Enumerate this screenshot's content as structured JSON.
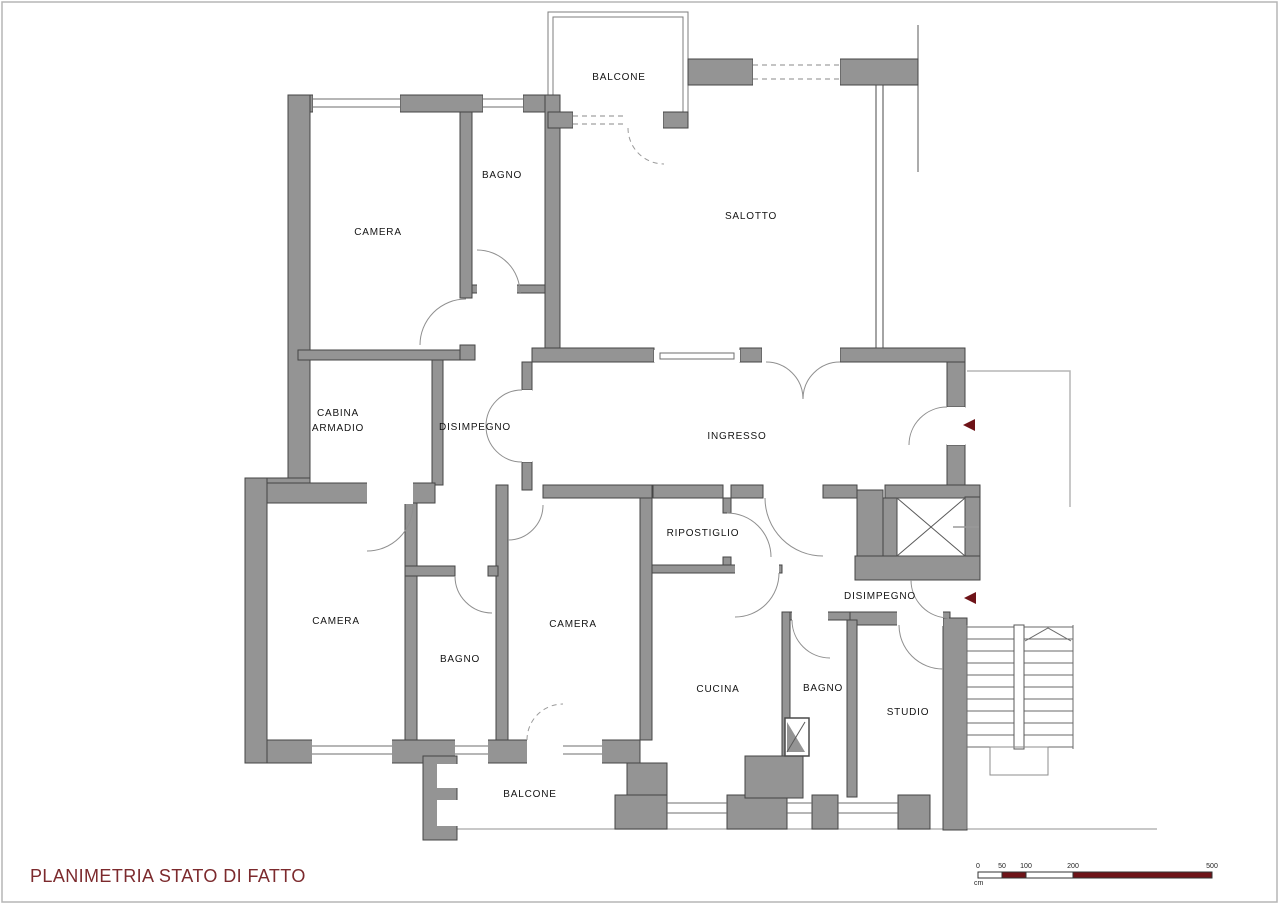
{
  "title": {
    "text": "PLANIMETRIA STATO DI FATTO",
    "color": "#7c2a2d"
  },
  "plan": {
    "rooms": {
      "balcone_top": {
        "label": "BALCONE"
      },
      "camera_nw": {
        "label": "CAMERA"
      },
      "bagno_nw": {
        "label": "BAGNO"
      },
      "salotto": {
        "label": "SALOTTO"
      },
      "cabina_armadio": {
        "line1": "CABINA",
        "line2": "ARMADIO"
      },
      "disimpegno_centro": {
        "label": "DISIMPEGNO"
      },
      "ingresso": {
        "label": "INGRESSO"
      },
      "ripostiglio": {
        "label": "RIPOSTIGLIO"
      },
      "camera_ovest": {
        "label": "CAMERA"
      },
      "bagno_ovest": {
        "label": "BAGNO"
      },
      "camera_sud": {
        "label": "CAMERA"
      },
      "cucina": {
        "label": "CUCINA"
      },
      "bagno_sud": {
        "label": "BAGNO"
      },
      "studio": {
        "label": "STUDIO"
      },
      "disimpegno_sud": {
        "label": "DISIMPEGNO"
      },
      "balcone_sud": {
        "label": "BALCONE"
      }
    },
    "markers": {
      "entrance_arrow_main": "left-triangle",
      "entrance_arrow_service": "left-triangle",
      "stairs_direction": "up-chevron"
    }
  },
  "scale_bar": {
    "ticks": [
      "0",
      "50",
      "100",
      "200",
      "500"
    ],
    "unit": "cm",
    "bar_color": "#6e1318"
  },
  "colors": {
    "wall_fill": "#949494",
    "wall_stroke": "#454545",
    "door_arc": "#8f8f8f",
    "light_outline": "#b5b5b5",
    "accent_red": "#6e1318",
    "label_text": "#141414",
    "page_border": "#b5b5b5"
  }
}
